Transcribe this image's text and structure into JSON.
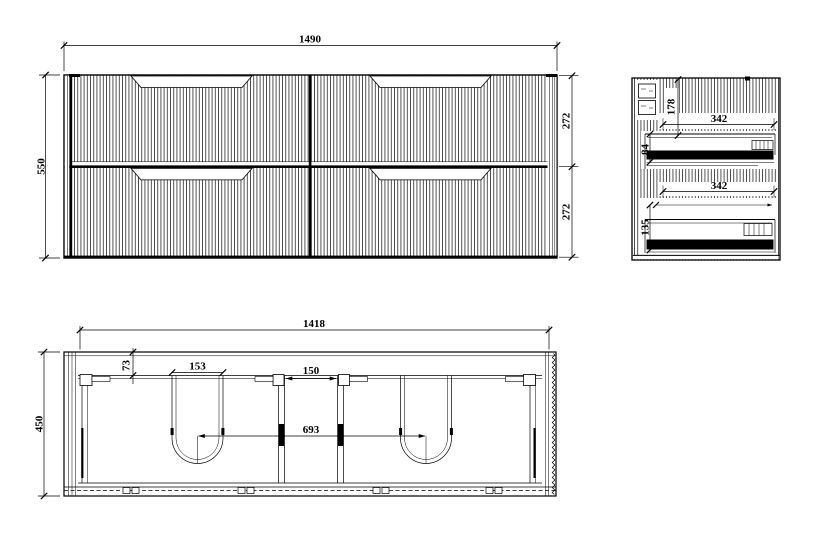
{
  "colors": {
    "background": "#ffffff",
    "line": "#000000"
  },
  "views": {
    "front": {
      "dims": {
        "overall_width": "1490",
        "overall_height": "550",
        "upper_drawer_height": "272",
        "lower_drawer_height": "272"
      }
    },
    "side": {
      "dims": {
        "top_clearance": "178",
        "upper_drawer_depth": "342",
        "upper_rail_height": "84",
        "lower_drawer_depth": "342",
        "lower_rail_height": "135"
      }
    },
    "plan": {
      "dims": {
        "internal_width": "1418",
        "overall_depth": "450",
        "back_rail_depth": "73",
        "cutout_width": "153",
        "centre_gap": "150",
        "drain_centres": "693"
      }
    }
  }
}
